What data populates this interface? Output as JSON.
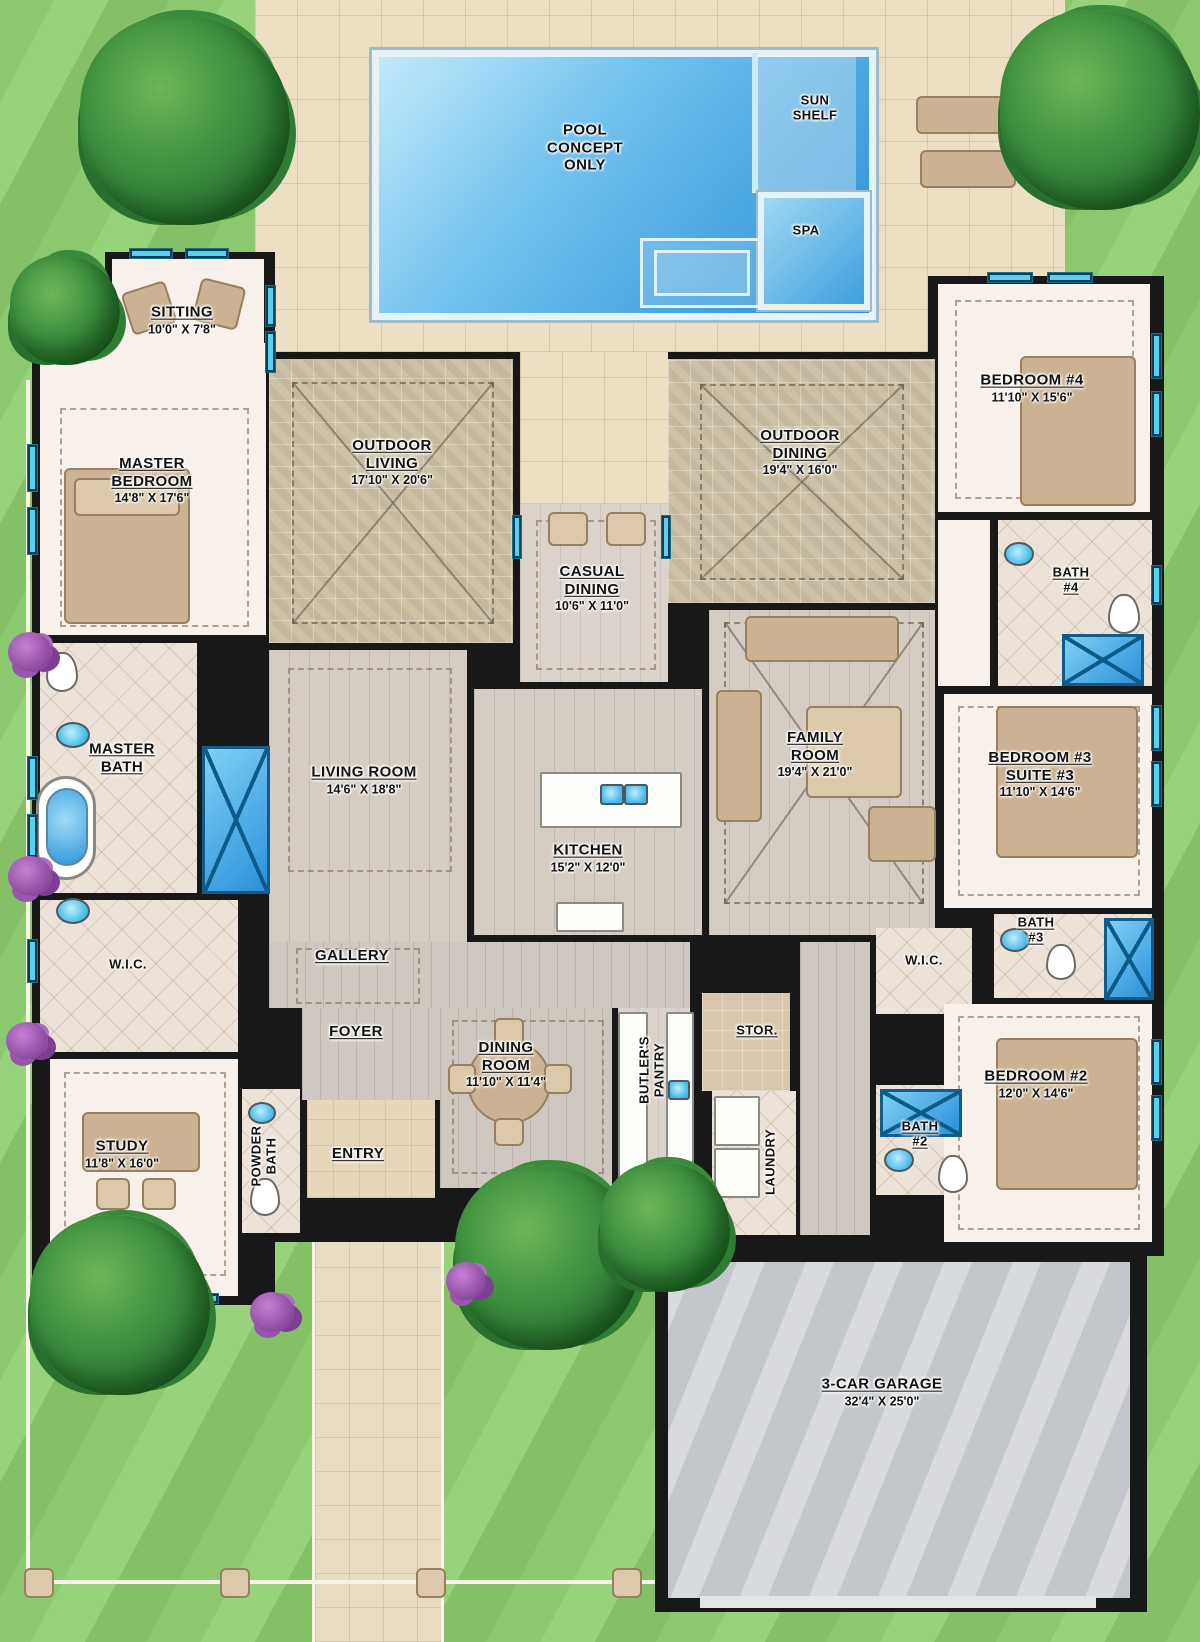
{
  "colors": {
    "grass": "#8bc96e",
    "pool_deck": "#ecdfc4",
    "pool_water": "#2a8fd4",
    "wall": "#181818",
    "interior_floor": "#f8f0ea",
    "outdoor_tile": "#cdc2a8",
    "wood_floor": "#d5ccc3",
    "window_accent": "#5ad0f0",
    "shower_blue": "#2b90d9",
    "garage_floor": "#c3c7cb",
    "furniture_tan": "#cbb292",
    "tree_green": "#3c8f3e",
    "bush_purple": "#8b4a9e"
  },
  "pool_area": {
    "pool_label": "POOL\nCONCEPT\nONLY",
    "sun_shelf_label": "SUN\nSHELF",
    "spa_label": "SPA"
  },
  "rooms": {
    "sitting": {
      "name": "SITTING",
      "dims": "10'0\" X 7'8\""
    },
    "master_bedroom": {
      "name": "MASTER\nBEDROOM",
      "dims": "14'8\" X 17'6\""
    },
    "outdoor_living": {
      "name": "OUTDOOR\nLIVING",
      "dims": "17'10\" X 20'6\""
    },
    "outdoor_dining": {
      "name": "OUTDOOR\nDINING",
      "dims": "19'4\" X 16'0\""
    },
    "bedroom4": {
      "name": "BEDROOM #4",
      "dims": "11'10\" X 15'6\""
    },
    "casual_dining": {
      "name": "CASUAL\nDINING",
      "dims": "10'6\" X 11'0\""
    },
    "bath4": {
      "name": "BATH\n#4",
      "dims": ""
    },
    "master_bath": {
      "name": "MASTER\nBATH",
      "dims": ""
    },
    "living_room": {
      "name": "LIVING ROOM",
      "dims": "14'6\" X 18'8\""
    },
    "family_room": {
      "name": "FAMILY\nROOM",
      "dims": "19'4\" X 21'0\""
    },
    "bedroom3": {
      "name": "BEDROOM #3\nSUITE #3",
      "dims": "11'10\" X 14'6\""
    },
    "kitchen": {
      "name": "KITCHEN",
      "dims": "15'2\" X 12'0\""
    },
    "wic_master": {
      "name": "W.I.C.",
      "dims": ""
    },
    "gallery": {
      "name": "GALLERY",
      "dims": ""
    },
    "bath3": {
      "name": "BATH\n#3",
      "dims": ""
    },
    "wic_right": {
      "name": "W.I.C.",
      "dims": ""
    },
    "foyer": {
      "name": "FOYER",
      "dims": ""
    },
    "dining_room": {
      "name": "DINING\nROOM",
      "dims": "11'10\" X 11'4\""
    },
    "butlers_pantry": {
      "name": "BUTLER'S\nPANTRY",
      "dims": ""
    },
    "storage": {
      "name": "STOR.",
      "dims": ""
    },
    "bedroom2": {
      "name": "BEDROOM #2",
      "dims": "12'0\" X 14'6\""
    },
    "study": {
      "name": "STUDY",
      "dims": "11'8\" X 16'0\""
    },
    "powder_bath": {
      "name": "POWDER\nBATH",
      "dims": ""
    },
    "entry": {
      "name": "ENTRY",
      "dims": ""
    },
    "laundry": {
      "name": "LAUNDRY",
      "dims": ""
    },
    "bath2": {
      "name": "BATH\n#2",
      "dims": ""
    },
    "garage": {
      "name": "3-CAR GARAGE",
      "dims": "32'4\" X 25'0\""
    }
  }
}
